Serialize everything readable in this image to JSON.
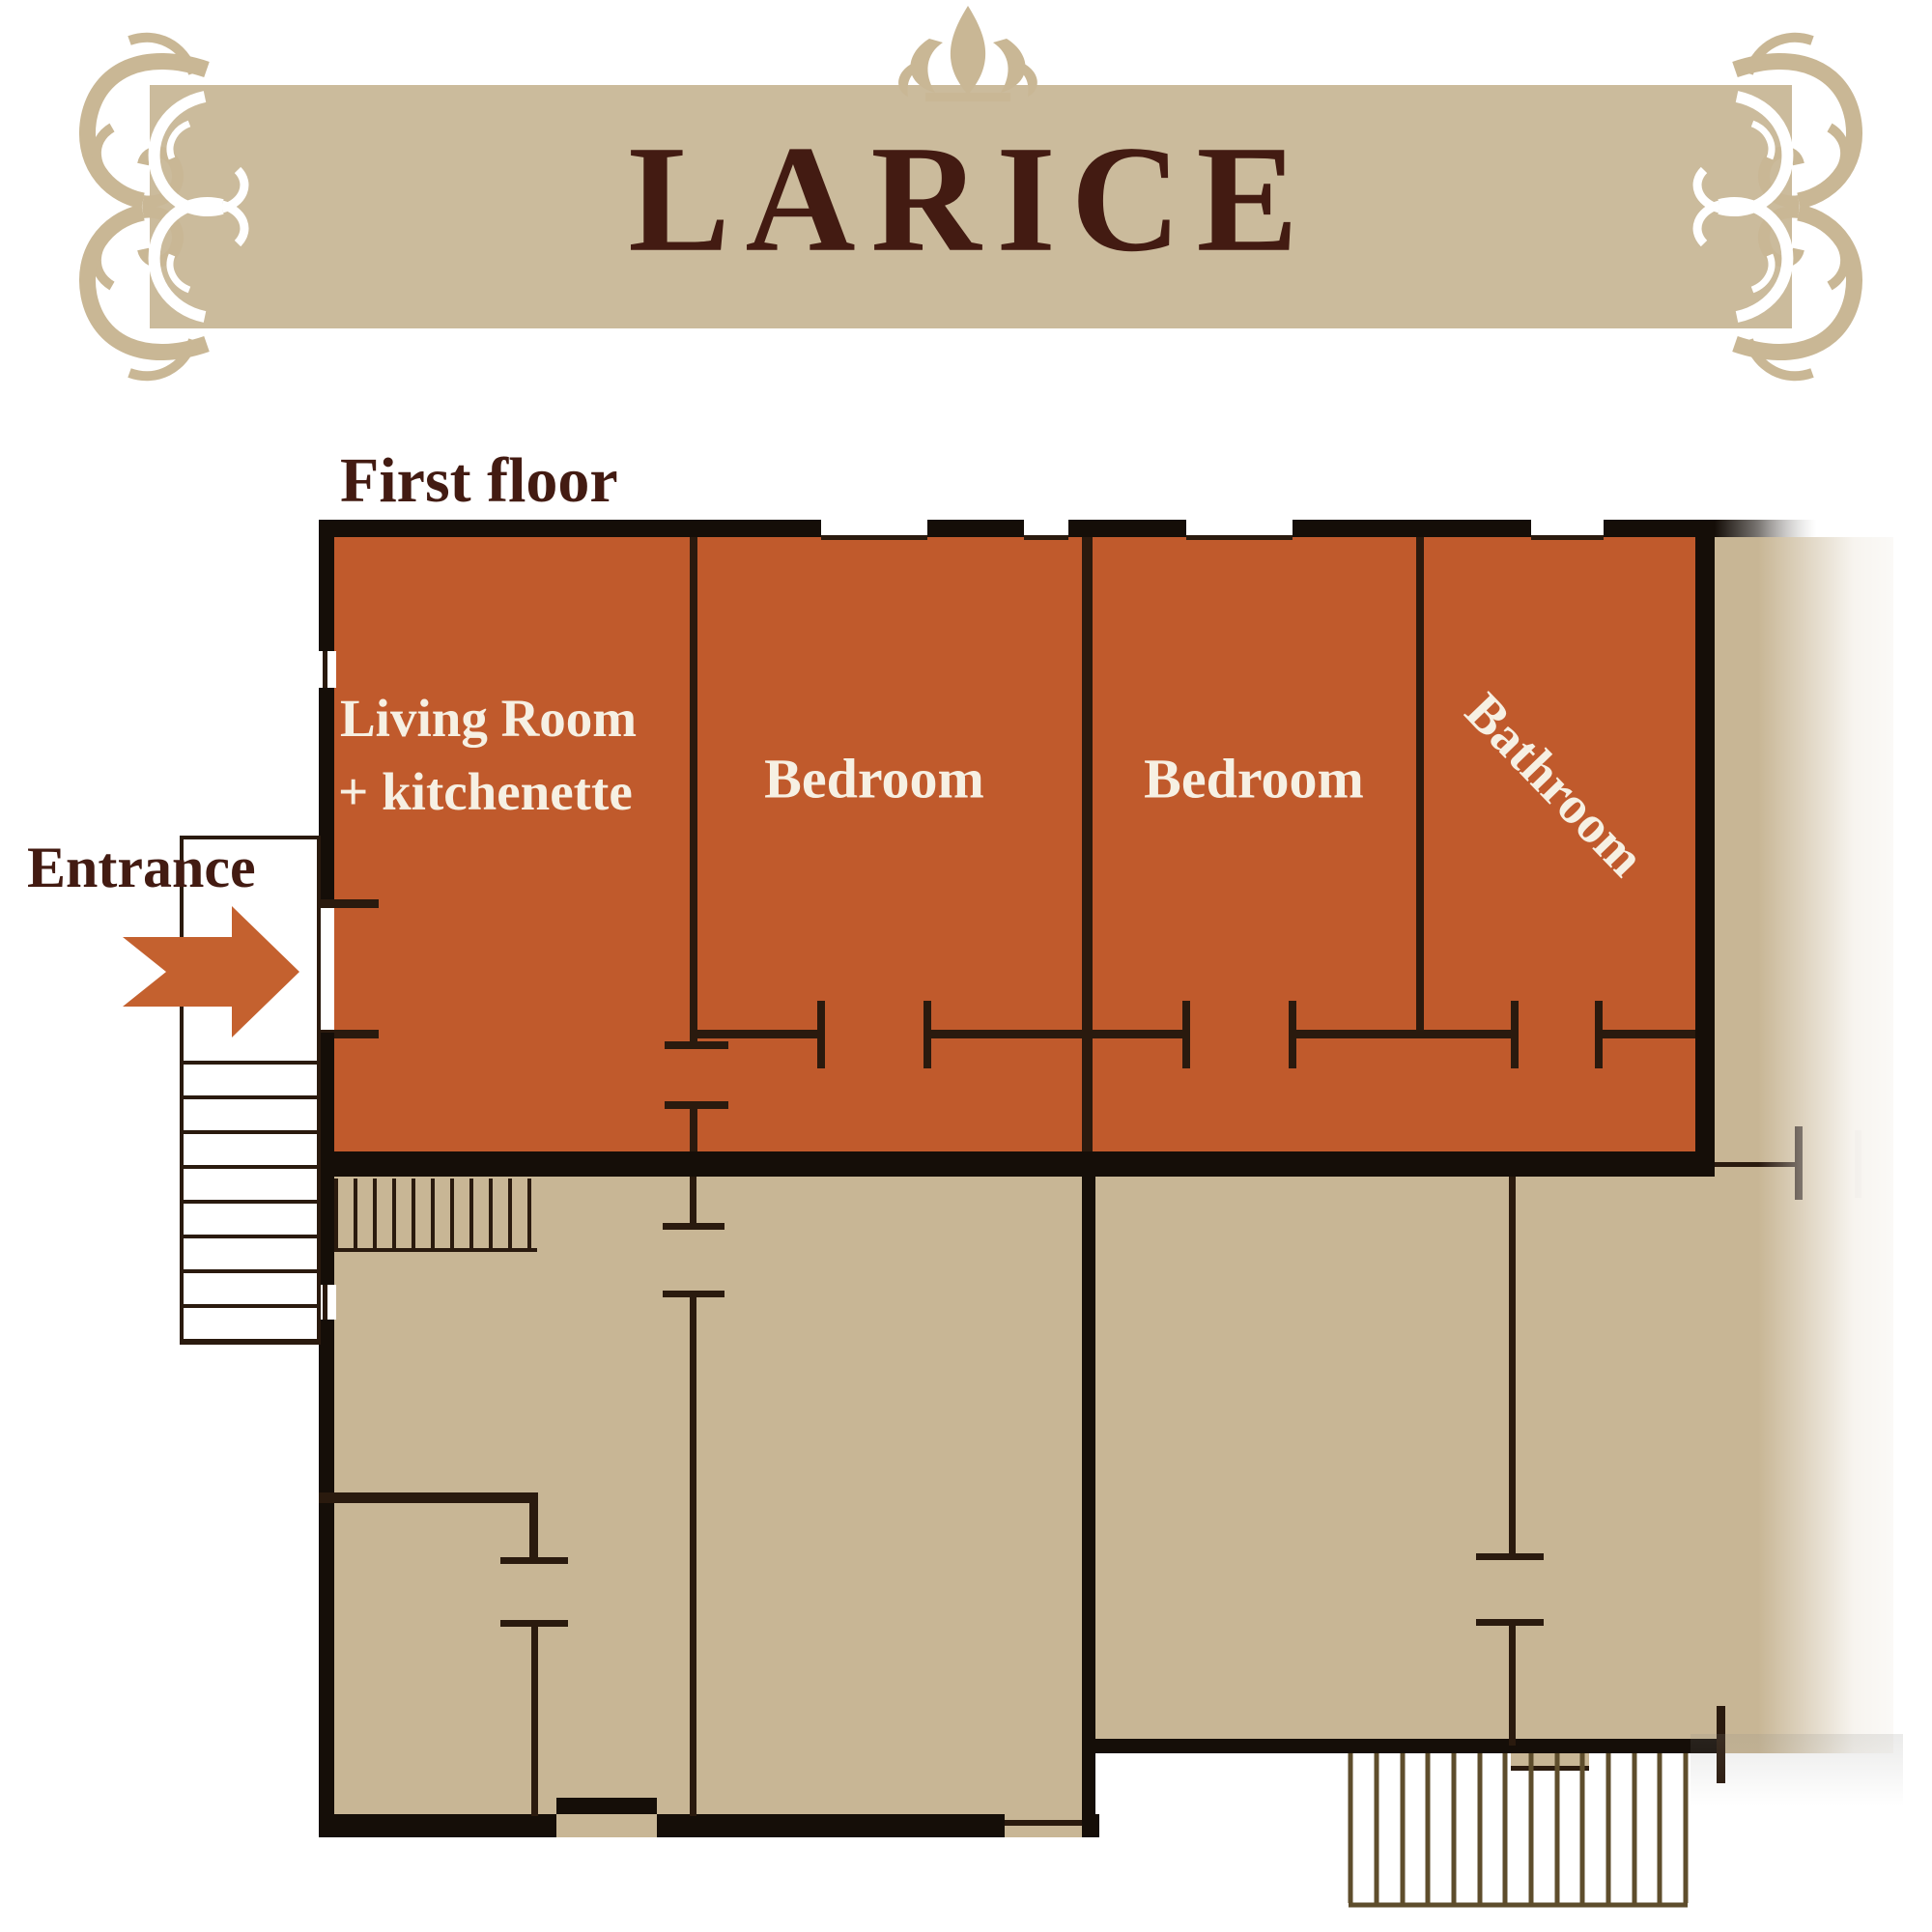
{
  "banner": {
    "title": "LARICE"
  },
  "plan": {
    "floor_label": "First floor",
    "entrance_label": "Entrance",
    "rooms": {
      "living_line1": "Living Room",
      "living_line2": "+ kitchenette",
      "bedroom_left": "Bedroom",
      "bedroom_right": "Bedroom",
      "bathroom": "Bathroom"
    }
  },
  "icons": {
    "entrance_arrow": "entrance-arrow-icon",
    "top_ornament": "fleur-ornament-icon",
    "corner_ornament": "corner-flourish-icon",
    "interior_stairs": "staircase-hatch-icon",
    "exterior_stairs": "staircase-hatch-icon",
    "porch_stairs": "staircase-treads-icon"
  },
  "colors": {
    "page-bg": "#ffffff",
    "banner-tan": "#cbbb9c",
    "ornament-tan": "#c9b795",
    "title-maroon": "#431b12",
    "apartment-orange": "#c05a2c",
    "floor-tan": "#c8b695",
    "wall-dark": "#150e08",
    "wall-thin": "#2a1a0e",
    "label-white": "#f6f0e3",
    "arrow-orange": "#c4612f",
    "stair-hatch": "#5e4d2c"
  }
}
